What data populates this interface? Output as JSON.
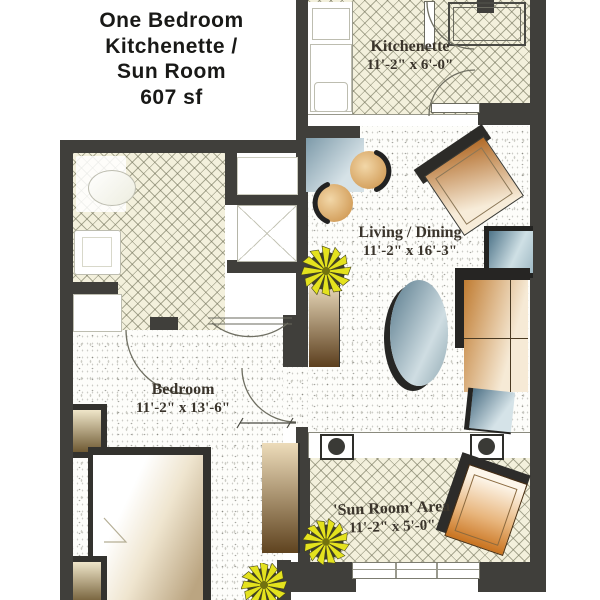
{
  "title": {
    "lines": [
      "One Bedroom",
      "Kitchenette /",
      "Sun Room",
      "607 sf"
    ]
  },
  "rooms": {
    "kitchenette": {
      "name": "Kitchenette",
      "dims": "11'-2\" x 6'-0\""
    },
    "living_dining": {
      "name": "Living / Dining",
      "dims": "11'-2\" x 16'-3\""
    },
    "bedroom": {
      "name": "Bedroom",
      "dims": "11'-2\" x 13'-6\""
    },
    "sun_room": {
      "name": "'Sun Room' Area",
      "dims": "11'-2\" x 5'-0\""
    }
  },
  "colors": {
    "wall": "#403f3b",
    "hatch_floor": "#f3f0dc",
    "speckle_floor": "#fdfdfa",
    "wood_furniture": "#c07c31",
    "upholstery_blue": "#6d8fa1",
    "plant_yellow": "#e4e21e",
    "label_text": "#3a342b",
    "title_text": "#191917"
  }
}
